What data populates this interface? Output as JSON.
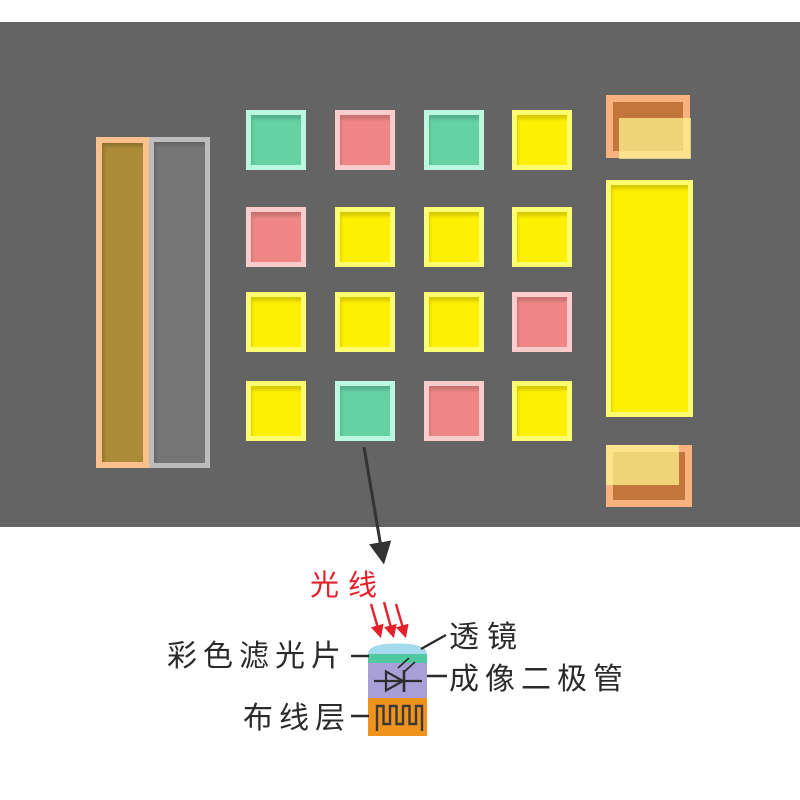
{
  "title": "image-sensor color filter array diagram",
  "colors": {
    "panel_bg": "#646464",
    "bar_olive_fill": "#AC8B38",
    "bar_olive_border": "#FBC18C",
    "bar_gray_fill": "#767676",
    "bar_gray_border": "#BDBDBD",
    "cell_green_fill": "#66D2A4",
    "cell_green_border": "#BCF7E0",
    "cell_red_fill": "#EF8787",
    "cell_red_border": "#FBCCCC",
    "cell_yellow_fill": "#FFF000",
    "cell_yellow_border": "#FCFC72",
    "frame_orange_border": "#F9B17E",
    "frame_orange_fill": "#C2763C",
    "overlay_yellow": "rgba(255,246,145,0.72)",
    "tall_yellow_fill": "#FFF000",
    "tall_yellow_border": "#FCFC72",
    "lens_blue": "#A6DAED",
    "filter_green": "#4FC9A0",
    "diode_purple": "#A79FD6",
    "wiring_orange": "#F0931D",
    "ray_red": "#E5212B",
    "label_black": "#2B2B2B",
    "arrow_black": "#333333",
    "symbol_black": "#2E2E2E"
  },
  "sensor_grid": {
    "rows": 4,
    "cols": 4,
    "cells": [
      "green",
      "red",
      "green",
      "yellow",
      "red",
      "yellow",
      "yellow",
      "yellow",
      "yellow",
      "yellow",
      "yellow",
      "red",
      "yellow",
      "green",
      "red",
      "yellow"
    ]
  },
  "labels": {
    "light_ray": "光线",
    "lens": "透镜",
    "color_filter": "彩色滤光片",
    "imaging_diode": "成像二极管",
    "wiring_layer": "布线层"
  }
}
